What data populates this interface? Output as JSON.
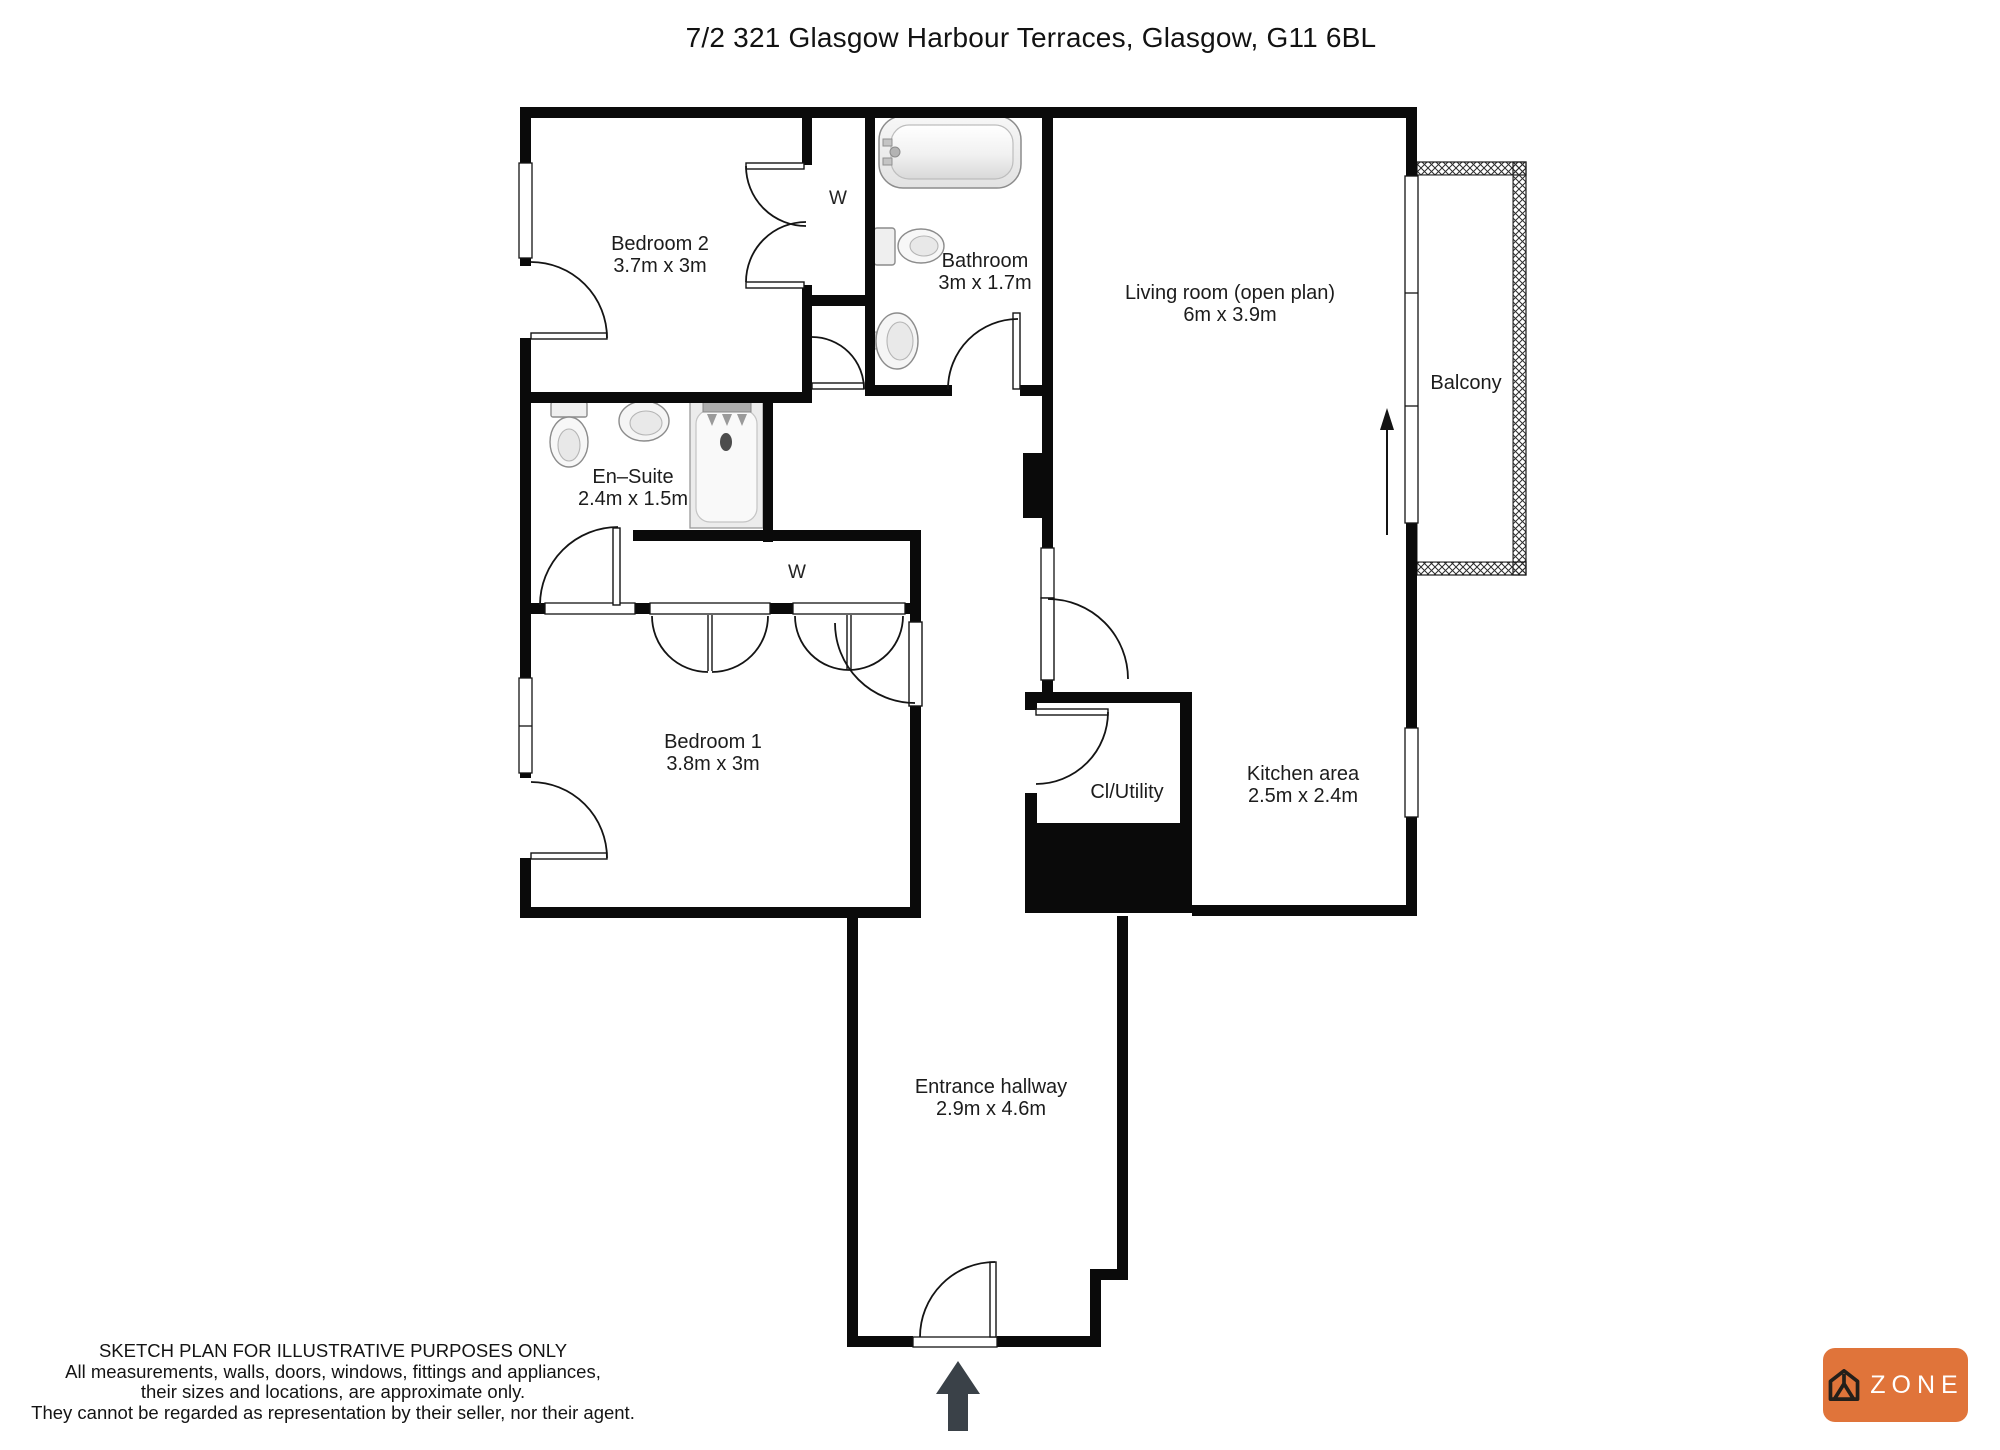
{
  "title": "7/2 321 Glasgow Harbour Terraces, Glasgow, G11 6BL",
  "rooms": {
    "bedroom2": {
      "name": "Bedroom 2",
      "dims": "3.7m x 3m"
    },
    "bathroom": {
      "name": "Bathroom",
      "dims": "3m x 1.7m"
    },
    "living_room": {
      "name": "Living room (open plan)",
      "dims": "6m x 3.9m"
    },
    "balcony": {
      "name": "Balcony"
    },
    "en_suite": {
      "name": "En–Suite",
      "dims": "2.4m x 1.5m"
    },
    "bedroom1": {
      "name": "Bedroom 1",
      "dims": "3.8m x 3m"
    },
    "cl_utility": {
      "name": "Cl/Utility"
    },
    "kitchen": {
      "name": "Kitchen area",
      "dims": "2.5m x 2.4m"
    },
    "hallway": {
      "name": "Entrance hallway",
      "dims": "2.9m x 4.6m"
    },
    "wardrobe_top": {
      "name": "W"
    },
    "wardrobe_middle": {
      "name": "W"
    }
  },
  "disclaimer": {
    "line1": "SKETCH PLAN FOR ILLUSTRATIVE PURPOSES ONLY",
    "line2": "All measurements, walls, doors, windows, fittings and appliances,",
    "line3": "their sizes and locations, are approximate only.",
    "line4": "They cannot be regarded as representation by their seller, nor their agent."
  },
  "logo": {
    "text": "ZONE"
  },
  "colors": {
    "wall": "#0a0a0a",
    "logo_orange": "#E0743A",
    "arrow_dark": "#3a4148"
  }
}
